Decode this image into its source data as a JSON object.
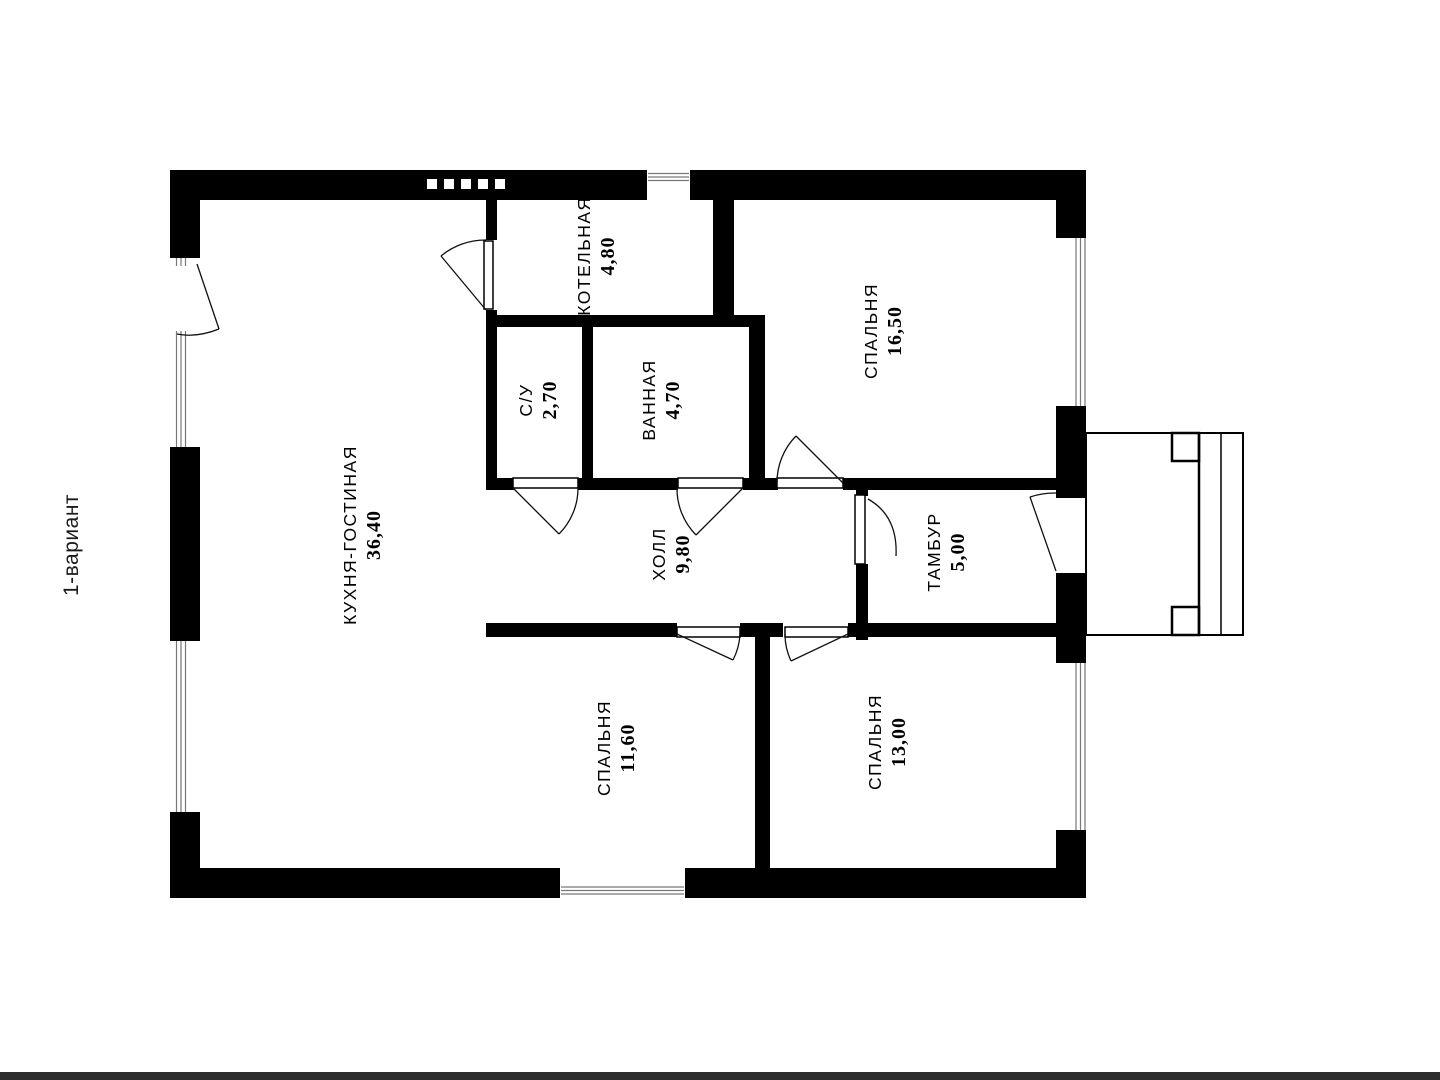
{
  "page": {
    "variant_label": "1-вариант"
  },
  "colors": {
    "wall": "#000000",
    "background": "#ffffff",
    "window_line": "#777777",
    "bottom_bar": "#2d2d2d"
  },
  "rooms": [
    {
      "id": "kitchen-living",
      "name": "КУХНЯ-ГОСТИНАЯ",
      "area": "36,40"
    },
    {
      "id": "boiler",
      "name": "КОТЕЛЬНАЯ",
      "area": "4,80"
    },
    {
      "id": "wc",
      "name": "С/У",
      "area": "2,70"
    },
    {
      "id": "bathroom",
      "name": "ВАННАЯ",
      "area": "4,70"
    },
    {
      "id": "bedroom-1",
      "name": "СПАЛЬНЯ",
      "area": "16,50"
    },
    {
      "id": "hall",
      "name": "ХОЛЛ",
      "area": "9,80"
    },
    {
      "id": "vestibule",
      "name": "ТАМБУР",
      "area": "5,00"
    },
    {
      "id": "bedroom-2",
      "name": "СПАЛЬНЯ",
      "area": "11,60"
    },
    {
      "id": "bedroom-3",
      "name": "СПАЛЬНЯ",
      "area": "13,00"
    }
  ]
}
